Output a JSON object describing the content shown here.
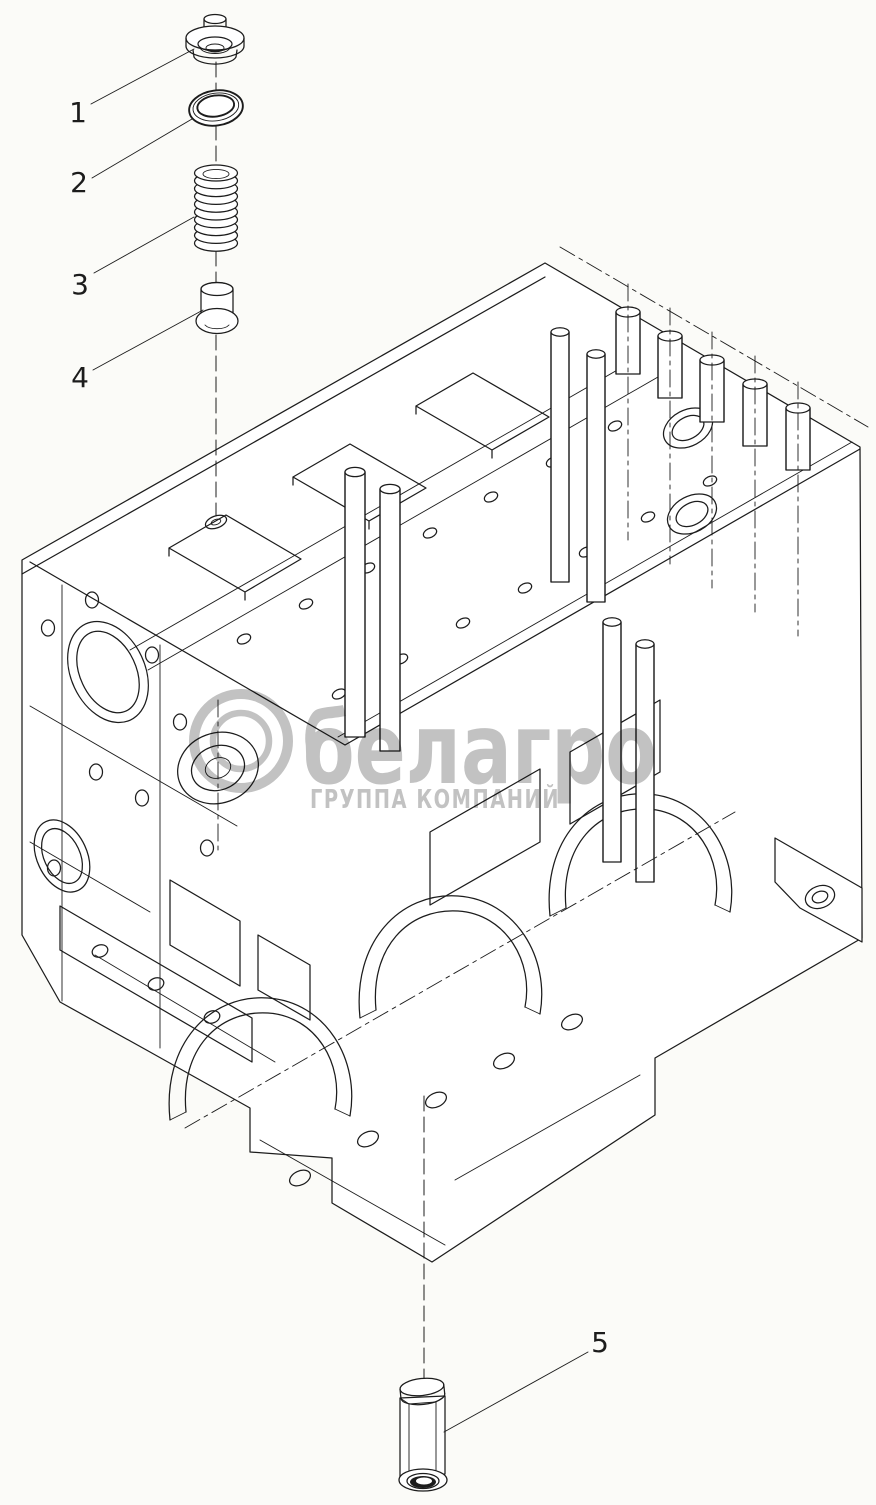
{
  "colors": {
    "background": "#fbfbf8",
    "line": "#1c1c1c",
    "watermark": "#c2c2c2"
  },
  "drawing": {
    "callouts": [
      {
        "label": "1"
      },
      {
        "label": "2"
      },
      {
        "label": "3"
      },
      {
        "label": "4"
      },
      {
        "label": "5"
      }
    ]
  },
  "watermark": {
    "text": "белагро",
    "subtext": "ГРУППА КОМПАНИЙ"
  }
}
